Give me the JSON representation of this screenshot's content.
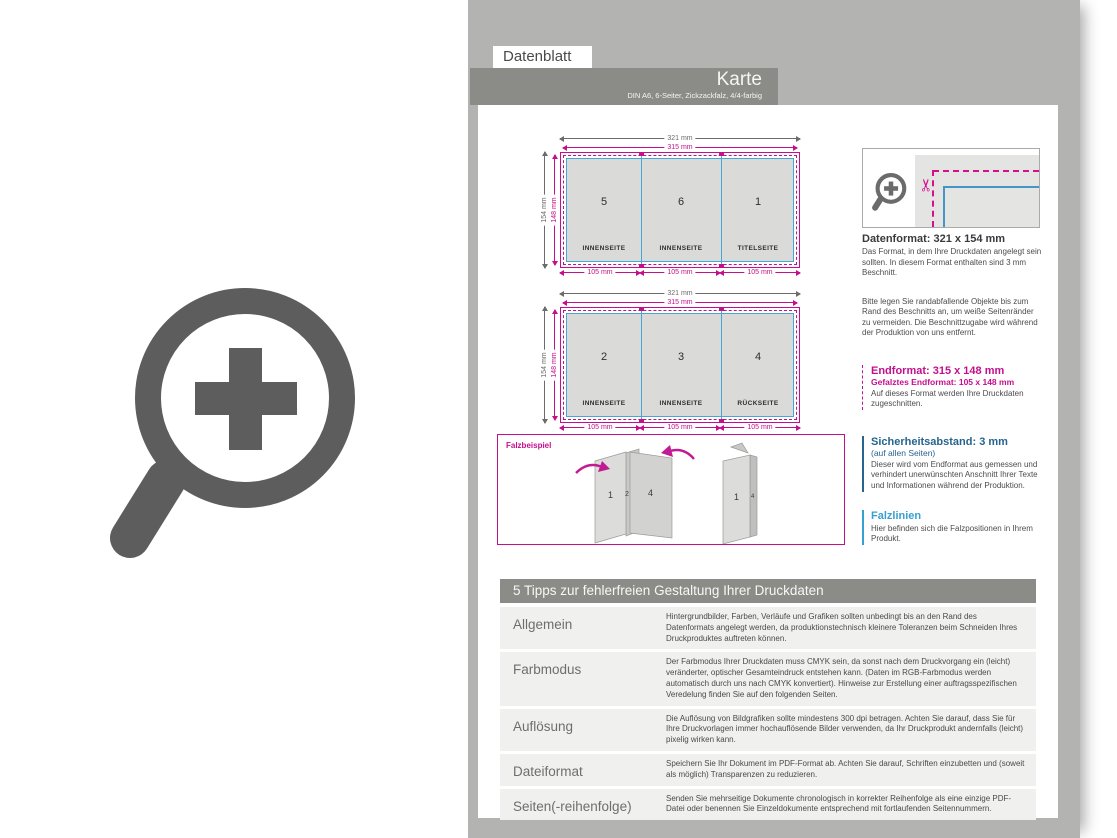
{
  "header": {
    "tab": "Datenblatt",
    "title": "Karte",
    "subtitle": "DIN A6, 6-Seiter, Zickzackfalz, 4/4-farbig"
  },
  "diagrams": {
    "dims": {
      "outer_width": "321 mm",
      "inner_width": "315 mm",
      "outer_height": "154 mm",
      "inner_height": "148 mm",
      "panel_width": "105 mm"
    },
    "sheet1": {
      "panels": [
        {
          "num": "5",
          "caption": "INNENSEITE"
        },
        {
          "num": "6",
          "caption": "INNENSEITE"
        },
        {
          "num": "1",
          "caption": "TITELSEITE"
        }
      ]
    },
    "sheet2": {
      "panels": [
        {
          "num": "2",
          "caption": "INNENSEITE"
        },
        {
          "num": "3",
          "caption": "INNENSEITE"
        },
        {
          "num": "4",
          "caption": "RÜCKSEITE"
        }
      ]
    },
    "falzbeispiel_label": "Falzbeispiel",
    "fold_example": {
      "figure_open_labels": [
        "1",
        "2",
        "4"
      ],
      "figure_closed_labels": [
        "1",
        "4"
      ]
    }
  },
  "info": {
    "datenformat": {
      "heading": "Datenformat: 321 x 154 mm",
      "body1": "Das Format, in dem Ihre Druckdaten angelegt sein sollten. In diesem Format enthalten sind 3 mm Beschnitt.",
      "body2": "Bitte legen Sie randabfallende Objekte bis zum Rand des Beschnitts an, um weiße Seitenränder zu vermeiden. Die Beschnittzugabe wird während der Produktion von uns entfernt."
    },
    "endformat": {
      "heading": "Endformat: 315 x 148 mm",
      "subheading": "Gefalztes Endformat: 105 x 148 mm",
      "body": "Auf dieses Format werden Ihre Druckdaten zugeschnitten."
    },
    "sicherheitsabstand": {
      "heading": "Sicherheitsabstand: 3 mm",
      "subheading": "(auf allen Seiten)",
      "body": "Dieser wird vom Endformat aus gemessen und verhindert unerwünschten Anschnitt Ihrer Texte und Informationen während der Produktion."
    },
    "falzlinien": {
      "heading": "Falzlinien",
      "body": "Hier befinden sich die Falzpositionen in Ihrem Produkt."
    }
  },
  "tips": {
    "header": "5 Tipps zur fehlerfreien Gestaltung Ihrer Druckdaten",
    "rows": [
      {
        "label": "Allgemein",
        "text": "Hintergrundbilder, Farben, Verläufe und Grafiken sollten unbedingt bis an den Rand des Datenformats angelegt werden, da produktionstechnisch kleinere Toleranzen beim Schneiden Ihres Druckproduktes auftreten können."
      },
      {
        "label": "Farbmodus",
        "text": "Der Farbmodus Ihrer Druckdaten muss CMYK sein, da sonst nach dem Druckvorgang ein (leicht) veränderter, optischer Gesamteindruck entstehen kann. (Daten im RGB-Farbmodus werden automatisch durch uns nach CMYK konvertiert). Hinweise zur Erstellung einer auftragsspezifischen Veredelung finden Sie auf den folgenden Seiten."
      },
      {
        "label": "Auflösung",
        "text": "Die Auflösung von Bildgrafiken sollte mindestens 300 dpi betragen. Achten Sie darauf, dass Sie für Ihre Druckvorlagen immer hochauflösende Bilder verwenden, da Ihr Druckprodukt andernfalls (leicht) pixelig wirken kann."
      },
      {
        "label": "Dateiformat",
        "text": "Speichern Sie Ihr Dokument im PDF-Format ab. Achten Sie darauf, Schriften einzubetten und (soweit als möglich) Transparenzen zu reduzieren."
      },
      {
        "label": "Seiten(-reihenfolge)",
        "text": "Senden Sie mehrseitige Dokumente chronologisch in korrekter Reihenfolge als eine einzige PDF-Datei oder benennen Sie Einzeldokumente entsprechend mit fortlaufenden Seitennummern."
      }
    ]
  },
  "icons": {
    "zoom_plus": "magnifier-with-plus",
    "scissors": "✂"
  },
  "colors": {
    "magenta": "#c50e8c",
    "fold_blue": "#45a7d4",
    "safety_blue": "#26648e",
    "falz_blue": "#36a0d0",
    "band_gray": "#8b8b87",
    "backdrop_gray": "#b3b3b1",
    "panel_fill": "#dadad8",
    "icon_gray": "#5d5d5d"
  }
}
